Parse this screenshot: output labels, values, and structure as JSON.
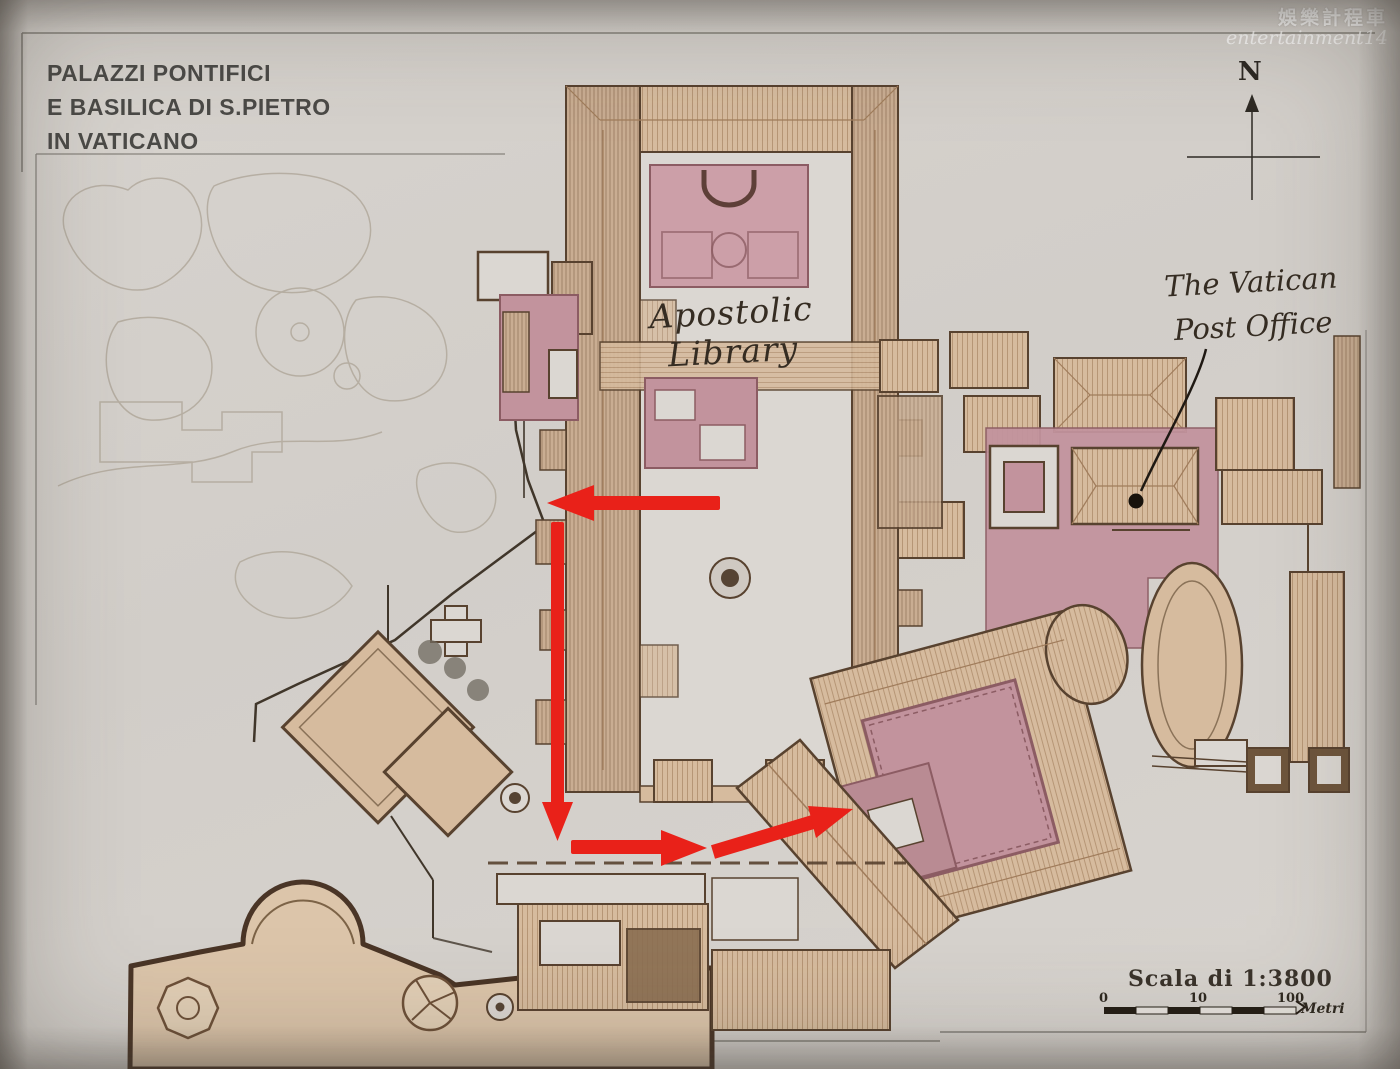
{
  "title": {
    "line1": "PALAZZI PONTIFICI",
    "line2": "E BASILICA DI S.PIETRO",
    "line3": "IN VATICANO"
  },
  "watermark": {
    "line1": "娛樂計程車",
    "line2": "entertainment14"
  },
  "annotations": {
    "library": "Apostolic Library",
    "post_office_line1": "The Vatican",
    "post_office_line2": "Post Office"
  },
  "compass": {
    "label": "N"
  },
  "scale": {
    "label": "Scala di 1:3800",
    "tick_0": "0",
    "tick_10": "10",
    "tick_100": "100",
    "unit": "Metri"
  },
  "colors": {
    "paper": "#d4d0cb",
    "courtyard": "#dbd7d2",
    "roof_tan": "#d6bb9e",
    "roof_line": "#a07c5b",
    "outline": "#58422f",
    "pink": "#c2939d",
    "pink_dark": "#8c5c63",
    "pink_light": "#cc9fa8",
    "mauve": "#b98b93",
    "arrow": "#e92119",
    "ink": "#3a3026",
    "garden": "#b1a99c",
    "title_gray": "#4b4a47",
    "wall_dark": "#4a3526",
    "basilica_fill": "#dcc5aa"
  }
}
